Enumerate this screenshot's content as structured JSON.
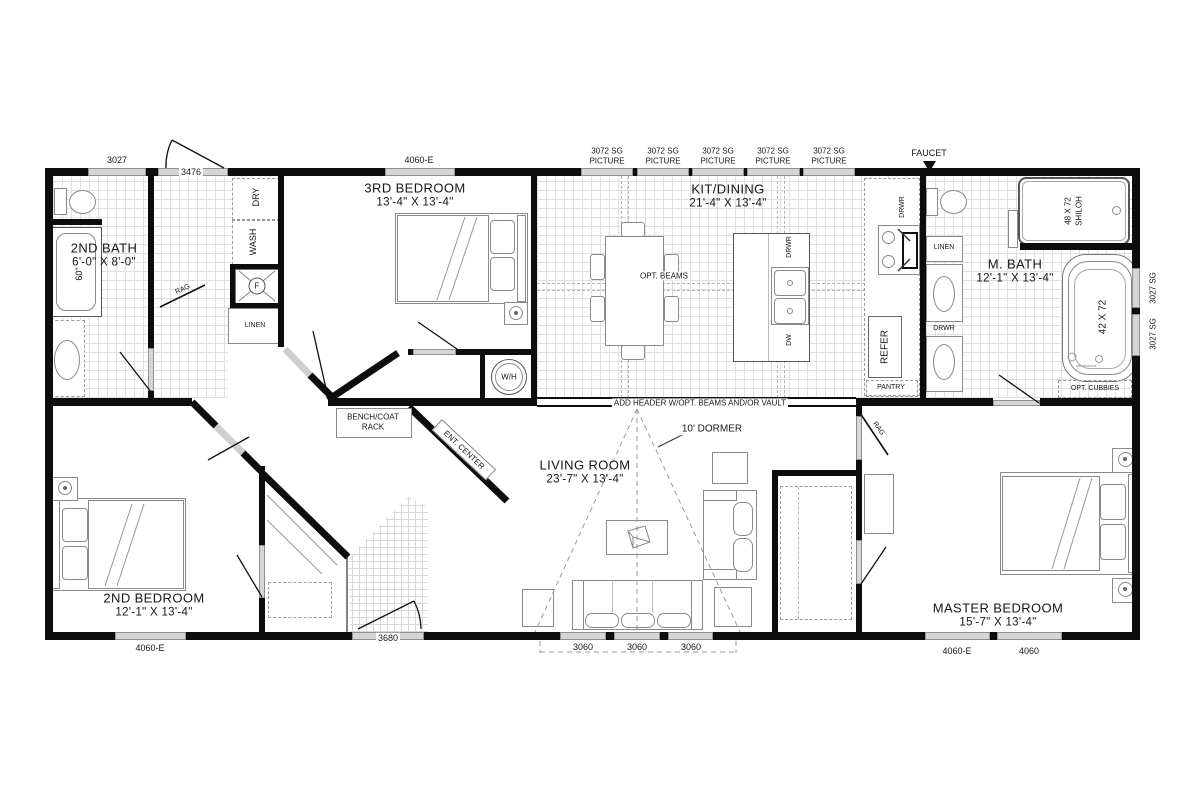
{
  "rooms": {
    "bath2": {
      "name": "2ND BATH",
      "dims": "6'-0\" X 8'-0\""
    },
    "bedroom3": {
      "name": "3RD BEDROOM",
      "dims": "13'-4\" X 13'-4\""
    },
    "kitdining": {
      "name": "KIT/DINING",
      "dims": "21'-4\" X 13'-4\""
    },
    "mbath": {
      "name": "M. BATH",
      "dims": "12'-1\" X 13'-4\""
    },
    "bedroom2": {
      "name": "2ND BEDROOM",
      "dims": "12'-1\" X 13'-4\""
    },
    "living": {
      "name": "LIVING ROOM",
      "dims": "23'-7\" X 13'-4\""
    },
    "master": {
      "name": "MASTER BEDROOM",
      "dims": "15'-7\" X 13'-4\""
    }
  },
  "openings": {
    "win_3027": "3027",
    "door_3476": "3476",
    "win_4060e": "4060-E",
    "picture_line1": "3072 SG",
    "picture_line2": "PICTURE",
    "faucet": "FAUCET",
    "win_3027sg": "3027 SG",
    "door_3680": "3680",
    "win_3060": "3060",
    "win_4060": "4060"
  },
  "features": {
    "wash": "WASH",
    "dry": "DRY",
    "furnace": "F",
    "linen": "LINEN",
    "rag": "RAG",
    "tub_60": "60\"",
    "wh": "W/H",
    "opt_beams": "OPT. BEAMS",
    "drwr": "DRWR",
    "dw": "DW",
    "refer": "REFER",
    "pantry": "PANTRY",
    "shower_size": "48 X 72",
    "shower_model": "SHILOH",
    "tub_size": "42 X 72",
    "opt_cubbies": "OPT. CUBBIES",
    "header_note": "ADD HEADER W/OPT. BEAMS AND/OR VAULT",
    "dormer": "10' DORMER",
    "bench_line1": "BENCH/COAT",
    "bench_line2": "RACK",
    "ent_center": "ENT. CENTER"
  }
}
